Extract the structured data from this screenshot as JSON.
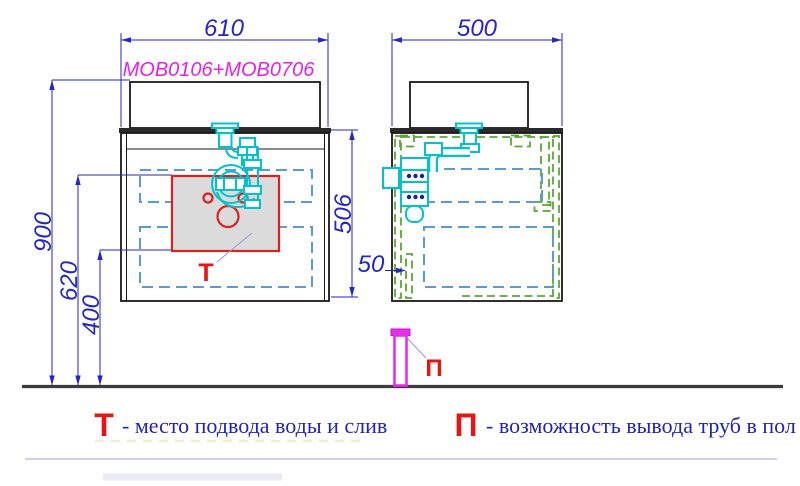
{
  "product_code": "MOB0106+MOB0706",
  "dims": {
    "width_front": "610",
    "depth_side": "500",
    "height_total": "900",
    "height_drain_top": "620",
    "height_drain_bottom": "400",
    "cabinet_height": "506",
    "floor_pipe_offset": "50"
  },
  "markers": {
    "water_point": "Т",
    "floor_pipe": "П"
  },
  "legend": {
    "water_marker": "Т",
    "water_text": "- место подвода воды и слив",
    "pipe_marker": "П",
    "pipe_text": "- возможность вывода труб в пол"
  },
  "colors": {
    "dimension_blue": "#2525c8",
    "product_label_magenta": "#e522e5",
    "marker_red": "#e81313",
    "plumbing_cyan": "#00c3cd",
    "drawer_hidden_blue": "#5b9bd5",
    "panel_hidden_green": "#5aa832",
    "floor_gray": "#3b3b3b"
  }
}
